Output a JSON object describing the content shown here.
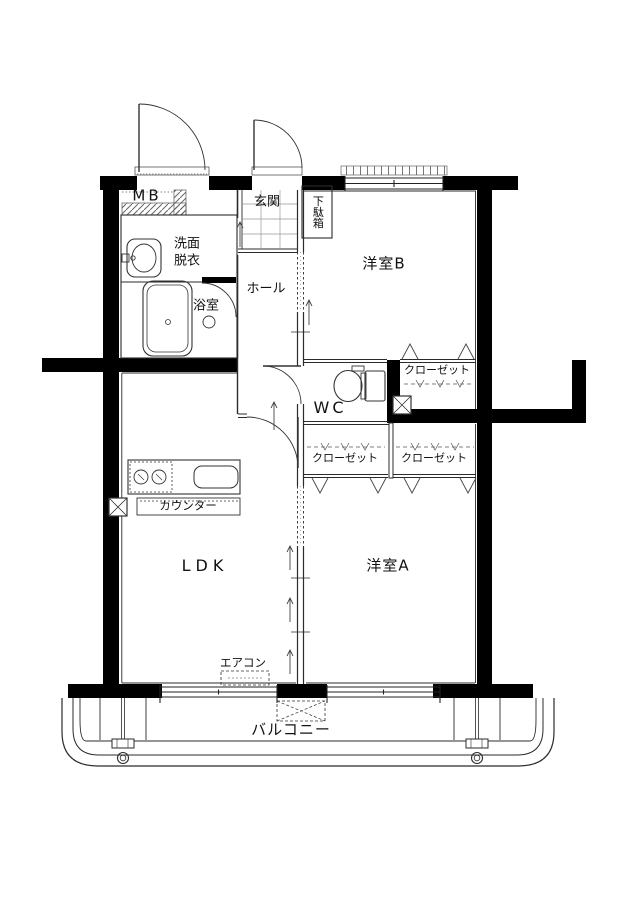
{
  "floor_plan": {
    "rooms": {
      "mb": "MB",
      "genkan": "玄関",
      "getabako": "下駄箱",
      "senmen_line1": "洗面",
      "senmen_line2": "脱衣",
      "yokushitsu": "浴室",
      "hall": "ホール",
      "western_room_b": "洋室B",
      "closet_b": "クローゼット",
      "wc": "WC",
      "closet_a_left": "クローゼット",
      "closet_a_right": "クローゼット",
      "counter": "カウンター",
      "ldk": "LDK",
      "western_room_a": "洋室A",
      "aircon": "エアコン",
      "balcony": "バルコニー"
    },
    "fixtures": {
      "toilet": "toilet-icon",
      "bathtub": "bathtub-icon",
      "washbasin": "washbasin-icon",
      "stove": "two-burner-stove-icon",
      "kitchen_sink": "kitchen-sink-icon",
      "ac_indoor": "air-conditioner-dashed-box",
      "ac_outdoor": "outdoor-unit-dashed-box",
      "drain": "balcony-drain-icon"
    },
    "colors": {
      "wall": "#000000",
      "line": "#2b2b2b",
      "hatch": "#666666",
      "background": "#ffffff"
    }
  }
}
